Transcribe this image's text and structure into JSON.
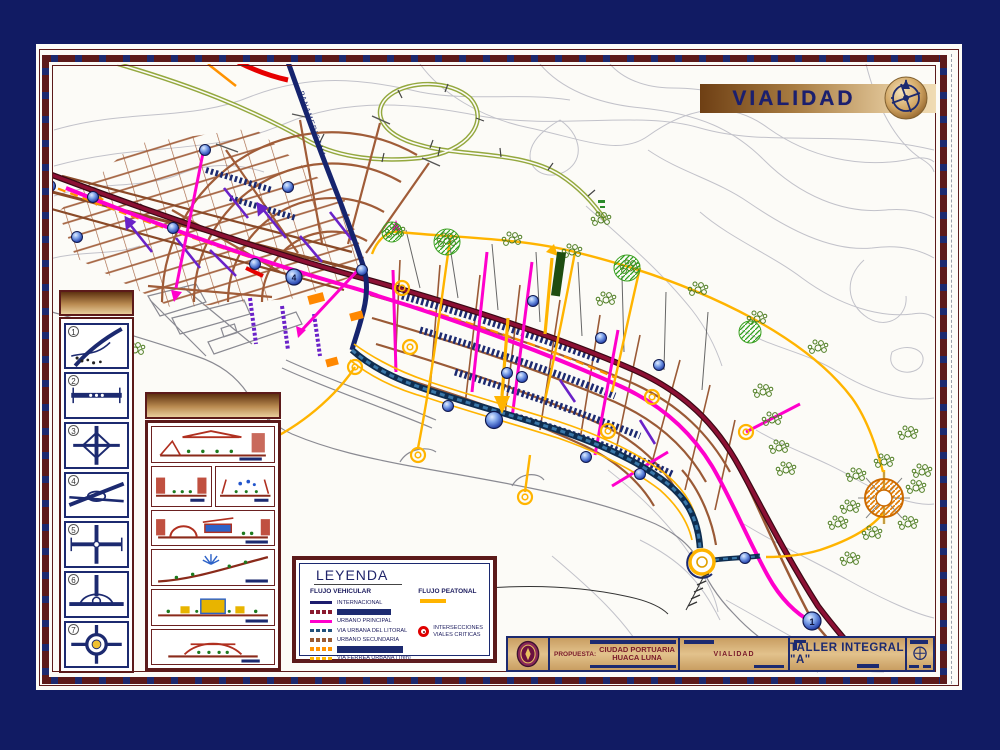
{
  "banner": {
    "title": "VIALIDAD"
  },
  "map": {
    "road_label_panamericana": "PANAMERICANA",
    "node_label_4": "4",
    "node_label_1": "1"
  },
  "intersections_panel": {
    "items": [
      "1",
      "2",
      "3",
      "4",
      "5",
      "6",
      "7"
    ]
  },
  "sections_panel": {
    "cell_count": 6
  },
  "legend": {
    "title": "LEYENDA",
    "vehicular_heading": "FLUJO VEHICULAR",
    "pedestrian_heading": "FLUJO PEATONAL",
    "vehicular": {
      "items": [
        {
          "label": "INTERNACIONAL",
          "color": "#1c1c6e",
          "style": "solid"
        },
        {
          "label": "",
          "bar": true,
          "color": "#8a1a2e",
          "style": "dashed"
        },
        {
          "label": "URBANO PRINCIPAL",
          "color": "#ff00cc",
          "style": "solid"
        },
        {
          "label": "VIA URBANA DEL LITORAL",
          "color": "#23527c",
          "style": "dashed"
        },
        {
          "label": "URBANO SECUNDARIA",
          "color": "#9a5a33",
          "style": "dashed"
        },
        {
          "label": "",
          "bar": true,
          "color": "#ff9200",
          "style": "dashed"
        },
        {
          "label": "VIA FERREA URBANA (Tren)",
          "color": "#ffb400",
          "style": "dashed"
        }
      ]
    },
    "pedestrian_swatch_color": "#ffb400",
    "critical_line1": "INTERSECCIONES",
    "critical_line2": "VIALES CRITICAS",
    "critical_color": "#e00000"
  },
  "title_block": {
    "proposal_label": "PROPUESTA:",
    "project_line1": "CIUDAD PORTUARIA",
    "project_line2": "HUACA LUNA",
    "sheet_name": "VIALIDAD",
    "studio": "TALLER INTEGRAL \"A\""
  },
  "colors": {
    "background_navy": "#111b63",
    "frame_maroon": "#5c1a1a",
    "gold_dark": "#6e3f14",
    "gold_light": "#ecd2a4",
    "title_navy": "#1b1f6e",
    "magenta": "#ff00cc",
    "urban_brown": "#9a5a36",
    "arterial_crimson": "#8c1034",
    "litoral_blue": "#23527c",
    "pedestrian_yellow": "#ffb400",
    "rail_orange": "#ff9200",
    "vegetation_green": "#4e7d22",
    "critical_red": "#e00000"
  }
}
